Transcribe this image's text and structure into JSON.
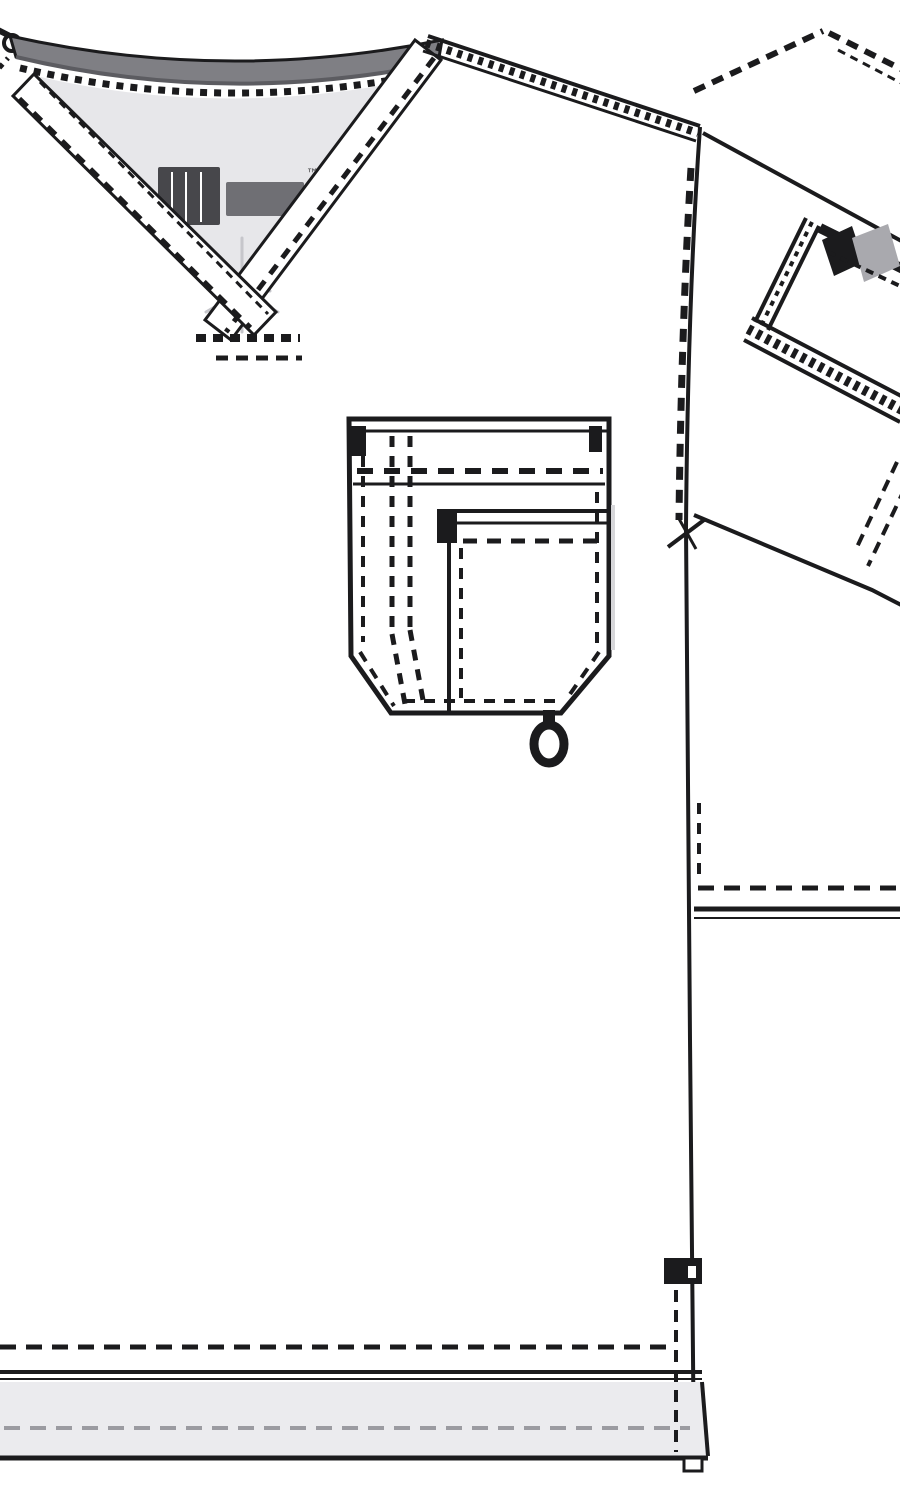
{
  "canvas": {
    "width": 900,
    "height": 1500,
    "background": "#ffffff"
  },
  "colors": {
    "line": "#1b1b1d",
    "white": "#ffffff",
    "collar_band": "#7f7f84",
    "collar_band_dark": "#5c5c61",
    "inner_back_panel": "#e7e7ea",
    "hem_band": "#ebebee",
    "hem_stitch_faint": "#9b9ba1",
    "label_ink": "#47474b",
    "label_ink_soft": "#6f6f74",
    "care_print": "#c6c6cb",
    "sleeve_pocket_shade": "#a9a9ae",
    "shadow_soft": "#d7d7da"
  },
  "label": {
    "trademark": "™"
  }
}
